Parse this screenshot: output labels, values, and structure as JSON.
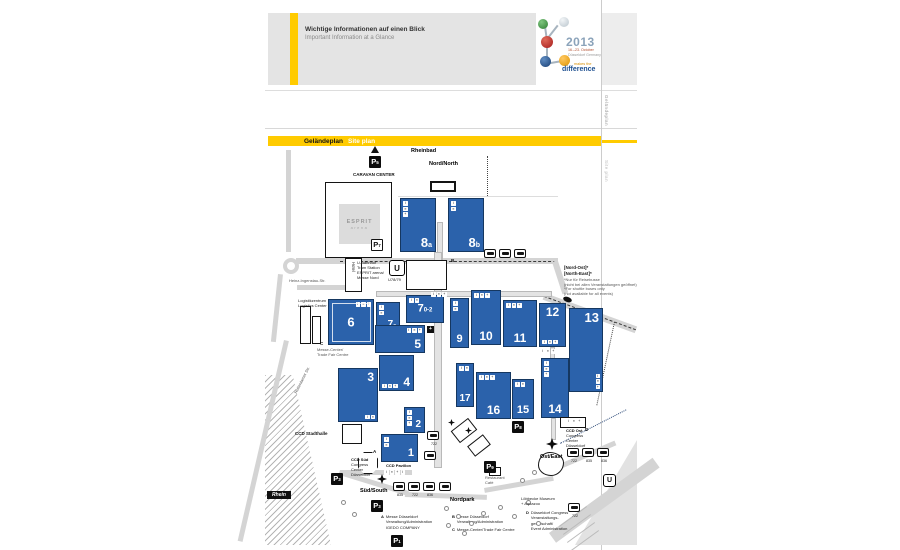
{
  "header": {
    "title_de": "Wichtige Informationen auf einen Blick",
    "title_en": "Important Information at a Glance"
  },
  "logo": {
    "year": "2013",
    "dates": "16.–23. October",
    "city": "Düsseldorf Germany",
    "tag1": "makes the",
    "tag2": "difference",
    "colors": {
      "green": "#2e7d32",
      "silver": "#c9d2d8",
      "red": "#b02020",
      "blue": "#1a4e8a",
      "orange": "#e89b00"
    }
  },
  "titlebar": {
    "de": "Geländeplan",
    "en": "Site plan"
  },
  "margin": {
    "v1": "Geländeplan",
    "v2": "Site plan"
  },
  "esprit": {
    "line1": "ESPRIT",
    "line2": "arena"
  },
  "rhein_label": "Rhein",
  "accent_yellow": "#ffcb00",
  "hall_blue": "#2b62ab",
  "map": {
    "icon_glyphs": [
      "i",
      "≡",
      "+"
    ],
    "halls": [
      {
        "n": "8",
        "sub": "a",
        "x": 400,
        "y": 198,
        "w": 36,
        "h": 54,
        "np": "br",
        "fs": 13,
        "ic": {
          "c": "tl",
          "d": "col",
          "n": 3
        }
      },
      {
        "n": "8",
        "sub": "b",
        "x": 448,
        "y": 198,
        "w": 36,
        "h": 54,
        "np": "br",
        "fs": 13,
        "ic": {
          "c": "tl",
          "d": "col",
          "n": 2
        }
      },
      {
        "n": "6",
        "sub": "",
        "x": 328,
        "y": 299,
        "w": 46,
        "h": 46,
        "np": "c",
        "fs": 13,
        "inner": true,
        "ic": {
          "c": "tr",
          "d": "row",
          "n": 3
        }
      },
      {
        "n": "7",
        "sub": "a",
        "x": 376,
        "y": 302,
        "w": 24,
        "h": 31,
        "np": "br",
        "fs": 10,
        "ic": {
          "c": "tl",
          "d": "col",
          "n": 2
        }
      },
      {
        "n": "7",
        "sub": "0-2",
        "x": 406,
        "y": 295,
        "w": 38,
        "h": 28,
        "np": "c",
        "fs": 11,
        "ic": {
          "c": "tl",
          "d": "row",
          "n": 2
        }
      },
      {
        "n": "5",
        "sub": "",
        "x": 375,
        "y": 325,
        "w": 50,
        "h": 28,
        "np": "br",
        "fs": 12,
        "ic": {
          "c": "tr",
          "d": "row",
          "n": 3
        }
      },
      {
        "n": "9",
        "sub": "",
        "x": 450,
        "y": 298,
        "w": 19,
        "h": 50,
        "np": "bc",
        "fs": 11,
        "ic": {
          "c": "tl",
          "d": "col",
          "n": 2
        }
      },
      {
        "n": "10",
        "sub": "",
        "x": 471,
        "y": 290,
        "w": 30,
        "h": 55,
        "np": "bc",
        "fs": 12,
        "ic": {
          "c": "tl",
          "d": "row",
          "n": 3
        }
      },
      {
        "n": "11",
        "sub": "",
        "x": 503,
        "y": 300,
        "w": 34,
        "h": 47,
        "np": "bc",
        "fs": 12,
        "ic": {
          "c": "tl",
          "d": "row",
          "n": 3
        }
      },
      {
        "n": "12",
        "sub": "",
        "x": 539,
        "y": 303,
        "w": 27,
        "h": 44,
        "np": "tc",
        "fs": 12,
        "ic": {
          "c": "bl",
          "d": "row",
          "n": 3
        }
      },
      {
        "n": "13",
        "sub": "",
        "x": 569,
        "y": 308,
        "w": 34,
        "h": 84,
        "np": "tr",
        "fs": 13,
        "ic": {
          "c": "br",
          "d": "col",
          "n": 3
        }
      },
      {
        "n": "3",
        "sub": "",
        "x": 338,
        "y": 368,
        "w": 40,
        "h": 54,
        "np": "tr",
        "fs": 12,
        "ic": {
          "c": "br",
          "d": "row",
          "n": 2
        }
      },
      {
        "n": "4",
        "sub": "",
        "x": 379,
        "y": 355,
        "w": 35,
        "h": 36,
        "np": "br",
        "fs": 12,
        "ic": {
          "c": "bl",
          "d": "row",
          "n": 3
        }
      },
      {
        "n": "2",
        "sub": "",
        "x": 404,
        "y": 407,
        "w": 21,
        "h": 26,
        "np": "br",
        "fs": 10,
        "ic": {
          "c": "tl",
          "d": "col",
          "n": 3
        }
      },
      {
        "n": "1",
        "sub": "",
        "x": 381,
        "y": 434,
        "w": 37,
        "h": 28,
        "np": "br",
        "fs": 11,
        "ic": {
          "c": "tl",
          "d": "col",
          "n": 2
        }
      },
      {
        "n": "17",
        "sub": "",
        "x": 456,
        "y": 363,
        "w": 18,
        "h": 44,
        "np": "bc",
        "fs": 10,
        "ic": {
          "c": "tl",
          "d": "row",
          "n": 2
        }
      },
      {
        "n": "16",
        "sub": "",
        "x": 476,
        "y": 372,
        "w": 35,
        "h": 47,
        "np": "bc",
        "fs": 12,
        "ic": {
          "c": "tl",
          "d": "row",
          "n": 3
        }
      },
      {
        "n": "15",
        "sub": "",
        "x": 512,
        "y": 379,
        "w": 22,
        "h": 40,
        "np": "bc",
        "fs": 11,
        "ic": {
          "c": "tl",
          "d": "row",
          "n": 2
        }
      },
      {
        "n": "14",
        "sub": "",
        "x": 541,
        "y": 358,
        "w": 28,
        "h": 60,
        "np": "bc",
        "fs": 12,
        "ic": {
          "c": "tl",
          "d": "col",
          "n": 3
        }
      }
    ],
    "buildings": [
      {
        "x": 430,
        "y": 181,
        "w": 26,
        "h": 11,
        "thick": true,
        "name": "rheinbad-building"
      },
      {
        "x": 345,
        "y": 258,
        "w": 17,
        "h": 34,
        "vlabel": "Hotel",
        "name": "hotel-building"
      },
      {
        "x": 406,
        "y": 260,
        "w": 41,
        "h": 30,
        "name": "north-entrance-building"
      },
      {
        "x": 300,
        "y": 306,
        "w": 11,
        "h": 38,
        "name": "logistics-building"
      },
      {
        "x": 312,
        "y": 316,
        "w": 9,
        "h": 28,
        "name": "logistics-building"
      },
      {
        "x": 342,
        "y": 424,
        "w": 20,
        "h": 20,
        "name": "ccd-stadthalle-building"
      },
      {
        "x": 358,
        "y": 452,
        "w": 20,
        "h": 22,
        "shape": "oct",
        "name": "ccd-sued-building"
      },
      {
        "x": 560,
        "y": 417,
        "w": 26,
        "h": 11,
        "name": "ccd-ost-building"
      },
      {
        "x": 453,
        "y": 423,
        "w": 22,
        "h": 15,
        "rot": -38,
        "name": "service-building"
      },
      {
        "x": 469,
        "y": 439,
        "w": 20,
        "h": 13,
        "rot": -38,
        "name": "service-building"
      },
      {
        "x": 489,
        "y": 467,
        "w": 12,
        "h": 9,
        "name": "restaurant-building"
      },
      {
        "x": 538,
        "y": 452,
        "w": 26,
        "h": 24,
        "shape": "blob",
        "name": "aquazoo-building"
      }
    ],
    "parkings": [
      {
        "sub": "5",
        "x": 369,
        "y": 156
      },
      {
        "sub": "7",
        "x": 371,
        "y": 239,
        "light": true
      },
      {
        "sub": "8",
        "x": 512,
        "y": 421
      },
      {
        "sub": "9",
        "x": 484,
        "y": 461
      },
      {
        "sub": "3",
        "x": 331,
        "y": 473
      },
      {
        "sub": "3",
        "x": 371,
        "y": 500
      },
      {
        "sub": "1",
        "x": 391,
        "y": 535
      }
    ],
    "bus_stops": [
      {
        "x": 484,
        "y": 249,
        "num": ""
      },
      {
        "x": 499,
        "y": 249,
        "num": ""
      },
      {
        "x": 514,
        "y": 249,
        "num": ""
      },
      {
        "x": 393,
        "y": 482,
        "num": "835"
      },
      {
        "x": 408,
        "y": 482,
        "num": "722"
      },
      {
        "x": 423,
        "y": 482,
        "num": "836"
      },
      {
        "x": 439,
        "y": 482,
        "num": ""
      },
      {
        "x": 567,
        "y": 448,
        "num": "722"
      },
      {
        "x": 582,
        "y": 448,
        "num": "835"
      },
      {
        "x": 597,
        "y": 448,
        "num": "836"
      },
      {
        "x": 568,
        "y": 503,
        "num": "722"
      },
      {
        "x": 427,
        "y": 431,
        "num": "722"
      },
      {
        "x": 424,
        "y": 451,
        "num": ""
      }
    ],
    "u_stations": [
      {
        "x": 389,
        "y": 260,
        "s": 14,
        "label": "U"
      },
      {
        "x": 603,
        "y": 474,
        "s": 11,
        "label": "U"
      }
    ],
    "entrances": [
      {
        "x": 377,
        "y": 474,
        "s": 10,
        "name": "sued-entrance-marker"
      },
      {
        "x": 546,
        "y": 438,
        "s": 12,
        "name": "ost-entrance-marker"
      },
      {
        "x": 448,
        "y": 419,
        "s": 7,
        "name": "road-marker"
      },
      {
        "x": 465,
        "y": 427,
        "s": 7,
        "name": "road-marker"
      }
    ],
    "icon_strips": [
      {
        "x": 540,
        "y": 349,
        "n": 3
      },
      {
        "x": 431,
        "y": 292,
        "n": 3
      },
      {
        "x": 384,
        "y": 470,
        "n": 4
      },
      {
        "x": 566,
        "y": 419,
        "n": 3
      }
    ],
    "trees": [
      [
        444,
        506
      ],
      [
        456,
        514
      ],
      [
        469,
        521
      ],
      [
        481,
        511
      ],
      [
        498,
        505
      ],
      [
        512,
        514
      ],
      [
        526,
        500
      ],
      [
        536,
        521
      ],
      [
        446,
        523
      ],
      [
        462,
        531
      ],
      [
        341,
        500
      ],
      [
        352,
        512
      ],
      [
        532,
        470
      ],
      [
        520,
        478
      ]
    ],
    "labels": [
      {
        "t": "Rheinbad",
        "x": 411,
        "y": 148,
        "c": "b5"
      },
      {
        "t": "Nord/North",
        "x": 429,
        "y": 161,
        "c": "b5"
      },
      {
        "t": "CARAVAN CENTER",
        "x": 353,
        "y": 172,
        "c": "t4b"
      },
      {
        "t": "U-Bahnhof\nTram Station\nESPRIT arena/\nMesse Nord",
        "x": 357,
        "y": 260,
        "c": "t3"
      },
      {
        "t": "U78/79",
        "x": 388,
        "y": 277,
        "c": "t3"
      },
      {
        "t": "[Nord-Ost]*\n[North-East]*",
        "x": 564,
        "y": 265,
        "c": "t4b"
      },
      {
        "t": "*Nur für Reisebusse\n(nicht bei allen Veranstaltungen geöffnet)",
        "x": 564,
        "y": 277,
        "c": "t3g"
      },
      {
        "t": "*For shuttle buses only\n(not available for all events)",
        "x": 564,
        "y": 286,
        "c": "t3g"
      },
      {
        "t": "Logistikzentrum\nLogistics Center",
        "x": 298,
        "y": 298,
        "c": "t3"
      },
      {
        "t": "Heinz-Ingenstau-Str.",
        "x": 289,
        "y": 278,
        "c": "t3g"
      },
      {
        "t": "Rotterdamer Str.",
        "x": 293,
        "y": 392,
        "c": "t3g",
        "rot": -63
      },
      {
        "t": "Messe-Center/\nTrade Fair Centre",
        "x": 317,
        "y": 347,
        "c": "t3g"
      },
      {
        "t": "CCD Stadthalle",
        "x": 295,
        "y": 431,
        "c": "t4b"
      },
      {
        "t": "CCD Süd",
        "x": 351,
        "y": 457,
        "c": "t3b"
      },
      {
        "t": "Congress\nCenter\nDüsseldorf",
        "x": 351,
        "y": 462,
        "c": "t3"
      },
      {
        "t": "CCD Pavillon",
        "x": 386,
        "y": 463,
        "c": "t3b"
      },
      {
        "t": "CCD Ost",
        "x": 566,
        "y": 428,
        "c": "t3b"
      },
      {
        "t": "Congress\nCenter\nDüsseldorf",
        "x": 566,
        "y": 433,
        "c": "t3"
      },
      {
        "t": "Ost/East",
        "x": 540,
        "y": 454,
        "c": "b5"
      },
      {
        "t": "Süd/South",
        "x": 360,
        "y": 488,
        "c": "b5"
      },
      {
        "t": "Nordpark",
        "x": 450,
        "y": 497,
        "c": "b5"
      },
      {
        "t": "Restaurant\nCafé",
        "x": 485,
        "y": 475,
        "c": "t3g"
      },
      {
        "t": "Löbbecke Museum\n+ Aquazoo",
        "x": 521,
        "y": 496,
        "c": "t3"
      },
      {
        "t": "A",
        "x": 373,
        "y": 449,
        "c": "t4b"
      },
      {
        "t": "B",
        "x": 451,
        "y": 258,
        "c": "t4b"
      },
      {
        "t": "C",
        "x": 320,
        "y": 341,
        "c": "t4b"
      },
      {
        "t": "D",
        "x": 585,
        "y": 427,
        "c": "t4b"
      }
    ],
    "legend": {
      "a_letter": "A",
      "a_text": "Messe Düsseldorf\nVerwaltung/Administration\nIGEDO COMPANY",
      "b_letter": "B",
      "b_text": "Messe Düsseldorf\nVerwaltung/Administration",
      "c_letter": "C",
      "c_text": "Messe-Center/Trade Fair Centre",
      "d_letter": "D",
      "d_text": "Düsseldorf Congress\nVeranstaltungs-\ngesellschaft/\nEvent Administration"
    }
  }
}
